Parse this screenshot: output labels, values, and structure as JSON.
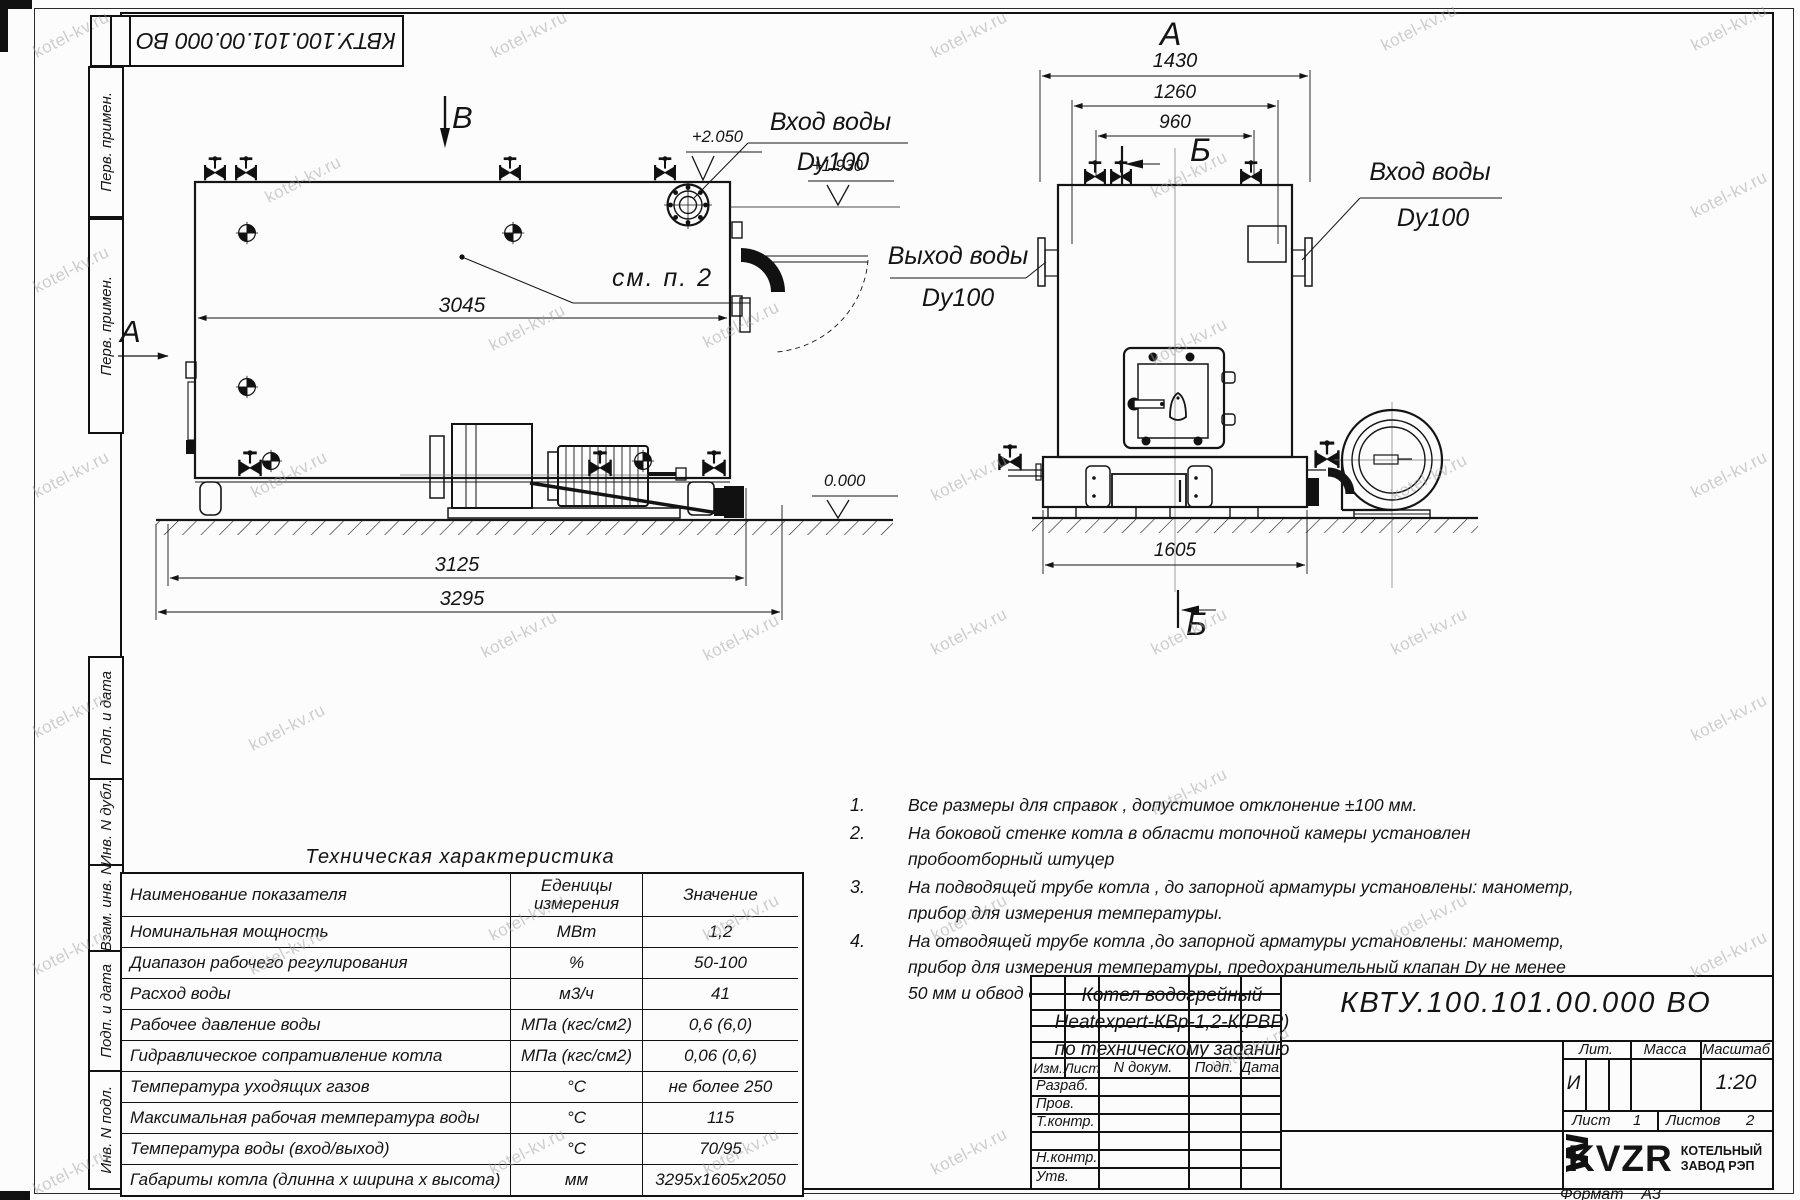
{
  "watermark": "kotel-kv.ru",
  "top_stamp": "КВТУ.100.101.00.000  ВО",
  "margin": {
    "perv_primen_1": "Перв. примен.",
    "perv_primen_2": "Перв. примен.",
    "podp_data_1": "Подп. и дата",
    "inv_dubl": "Инв. N дубл.",
    "vzam_inv": "Взам. инв. N",
    "podp_data_2": "Подп. и дата",
    "inv_podl": "Инв. N подл."
  },
  "side_view": {
    "view_label_top": "В",
    "view_label_left": "А",
    "callout": "см. п. 2",
    "dim_body": "3045",
    "dim_frame": "3125",
    "dim_total": "3295",
    "level_top": "+2.050",
    "level_nozzle": "+1.930",
    "level_ground": "0.000",
    "inlet_line1": "Вход воды",
    "inlet_line2": "Dy100"
  },
  "front_view": {
    "view_label_top": "А",
    "section_label_top": "Б",
    "section_label_bottom": "Б",
    "dim_1430": "1430",
    "dim_1260": "1260",
    "dim_960": "960",
    "dim_1605": "1605",
    "outlet_line1": "Выход воды",
    "outlet_line2": "Dy100",
    "inlet_line1": "Вход воды",
    "inlet_line2": "Dy100"
  },
  "notes": [
    {
      "num": "1.",
      "text": "Все размеры для справок , допустимое отклонение  ±100 мм."
    },
    {
      "num": "2.",
      "text": "На боковой стенке котла в области топочной камеры установлен пробоотборный штуцер"
    },
    {
      "num": "3.",
      "text": "На  подводящей трубе котла , до запорной арматуры установлены: манометр, прибор для измерения температуры."
    },
    {
      "num": "4.",
      "text": "На отводящей трубе котла ,до запорной арматуры установлены: манометр, прибор для измерения температуры, предохранительный клапан  Dу не менее  50 мм и обвод с обратным клапаном  Dу не менее  50 мм."
    }
  ],
  "spec_table": {
    "title": "Техническая характеристика",
    "col_name": "Наименование показателя",
    "col_units_1": "Еденицы",
    "col_units_2": "измерения",
    "col_value": "Значение",
    "rows": [
      {
        "name": "Номинальная мощность",
        "units": "МВт",
        "value": "1,2"
      },
      {
        "name": "Диапазон рабочего регулирования",
        "units": "%",
        "value": "50-100"
      },
      {
        "name": "Расход воды",
        "units": "м3/ч",
        "value": "41"
      },
      {
        "name": "Рабочее давление воды",
        "units": "МПа (кгс/см2)",
        "value": "0,6 (6,0)"
      },
      {
        "name": "Гидравлическое сопративление котла",
        "units": "МПа (кгс/см2)",
        "value": "0,06 (0,6)"
      },
      {
        "name": "Температура уходящих газов",
        "units": "°С",
        "value": "не более 250"
      },
      {
        "name": "Максимальная рабочая температура воды",
        "units": "°С",
        "value": "115"
      },
      {
        "name": "Температура воды (вход/выход)",
        "units": "°С",
        "value": "70/95"
      },
      {
        "name": "Габариты котла (длинна х ширина х высота)",
        "units": "мм",
        "value": "3295х1605х2050"
      }
    ]
  },
  "title_block": {
    "designation": "КВТУ.100.101.00.000  ВО",
    "name_line1": "Котел водогрейный",
    "name_line2": "Heatexpert-КВр-1,2-К(РВР)",
    "name_line3": "по техническому заданию",
    "col_izm": "Изм.",
    "col_list": "Лист",
    "col_docum": "N докум.",
    "col_podp": "Подп.",
    "col_data": "Дата",
    "row_razrab": "Разраб.",
    "row_prov": "Пров.",
    "row_tkontr": "Т.контр.",
    "row_nkontr": "Н.контр.",
    "row_utv": "Утв.",
    "lit_header": "Лит.",
    "massa_header": "Масса",
    "masshtab_header": "Масштаб",
    "lit_value": "И",
    "masshtab_value": "1:20",
    "list_label": "Лист",
    "list_value": "1",
    "listov_label": "Листов",
    "listov_value": "2",
    "logo_text": "KVZR",
    "logo_line1": "КОТЕЛЬНЫЙ",
    "logo_line2": "ЗАВОД РЭП",
    "format_label": "Формат",
    "format_value": "А3"
  }
}
